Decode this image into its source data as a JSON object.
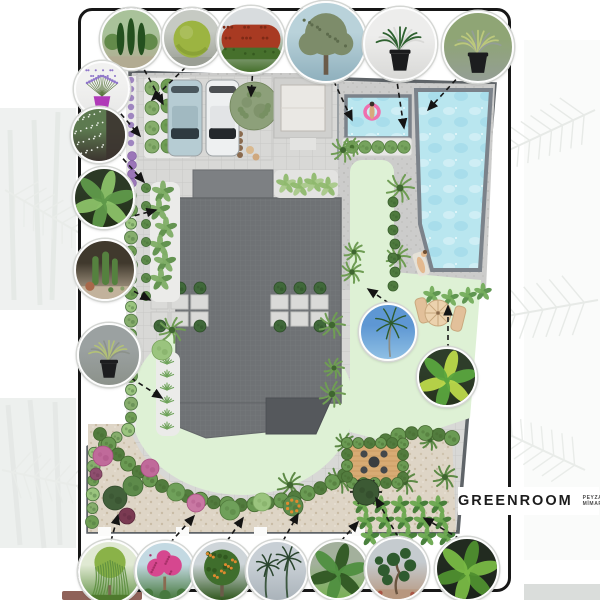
{
  "poster": {
    "kind": "residential-landscape-plan"
  },
  "logo": {
    "brand": "GREENROOM",
    "tagline_line1": "PEYZAJ",
    "tagline_line2": "MİMARLIK"
  },
  "site": {
    "colors": {
      "paving": "#d8d8d6",
      "tile_line": "#c8c8c6",
      "deck": "#cccccb",
      "gravel": "#ded5c6",
      "lawn": "#def1d5",
      "water": "#b9e6ef",
      "pool_edge": "#7b828a",
      "roof_dark": "#6f7275",
      "roof_mid": "#7d8083",
      "roof_low": "#55585c",
      "hedge": "#6a9a53",
      "hedge_dark": "#527c3e",
      "boundary": "#5f6468",
      "wood_deck": "#d8ab74",
      "umbrella": "#ecd2ae"
    },
    "figures": [
      "person-on-pink-float",
      "sunbathing-person"
    ]
  },
  "callouts": [
    {
      "name": "cypress-garden-photo",
      "glyph": "cypress",
      "x": 129,
      "y": 37,
      "r": 29,
      "sky": "#a9c29a",
      "mid": "#56813c",
      "base": "#b2ab92",
      "accent": "#24501f"
    },
    {
      "name": "boxwood-ball-photo",
      "glyph": "ball",
      "x": 190,
      "y": 36,
      "r": 28,
      "sky": "#c6cac3",
      "mid": "#9cb441",
      "base": "#9a9e94",
      "accent": "#778f2b"
    },
    {
      "name": "photinia-hedge-photo",
      "glyph": "hedge",
      "x": 249,
      "y": 38,
      "r": 32,
      "sky": "#d8dcde",
      "mid": "#a83a22",
      "base": "#46702c",
      "accent": "#7e2a16"
    },
    {
      "name": "olive-tree-photo",
      "glyph": "tree",
      "x": 324,
      "y": 40,
      "r": 39,
      "sky": "#b9d2da",
      "mid": "#7d8c6a",
      "base": "#8fb0bd",
      "accent": "#5d6b4c"
    },
    {
      "name": "sago-palm-pot-photo",
      "glyph": "potted",
      "x": 398,
      "y": 42,
      "r": 35,
      "sky": "#ededec",
      "mid": "#2f6230",
      "base": "#d9d9d7",
      "accent": "#1a1b1d"
    },
    {
      "name": "yucca-pot-photo",
      "glyph": "potted",
      "x": 476,
      "y": 45,
      "r": 34,
      "sky": "#8fa575",
      "mid": "#bcc87c",
      "base": "#949e95",
      "accent": "#1c1d1f"
    },
    {
      "name": "lavender-pot-photo",
      "glyph": "flowerpot",
      "x": 100,
      "y": 87,
      "r": 26,
      "sky": "#f1f1f0",
      "mid": "#8f76c9",
      "base": "#e8e8e7",
      "accent": "#b03ab8"
    },
    {
      "name": "jasmine-wall-photo",
      "glyph": "speckle-wall",
      "x": 97,
      "y": 133,
      "r": 26,
      "sky": "#5d7a50",
      "mid": "#eff3ec",
      "base": "#3c3430",
      "accent": "#50694a"
    },
    {
      "name": "tropical-banana-photo",
      "glyph": "banana",
      "x": 102,
      "y": 196,
      "r": 29,
      "sky": "#2c3a26",
      "mid": "#5f994a",
      "base": "#233018",
      "accent": "#8bc168"
    },
    {
      "name": "cactus-garden-photo",
      "glyph": "cactus",
      "x": 103,
      "y": 268,
      "r": 29,
      "sky": "#40392d",
      "mid": "#55813f",
      "base": "#c2b29c",
      "accent": "#a8684a"
    },
    {
      "name": "yucca-pot-2-photo",
      "glyph": "potted",
      "x": 107,
      "y": 353,
      "r": 30,
      "sky": "#9ba1a1",
      "mid": "#b3c177",
      "base": "#8c928b",
      "accent": "#1c1d1f"
    },
    {
      "name": "coconut-palm-photo",
      "glyph": "palm",
      "x": 386,
      "y": 330,
      "r": 27,
      "sky": "#5e97d3",
      "mid": "#2e5b2b",
      "base": "#8fc0e4",
      "accent": "#8d8d84"
    },
    {
      "name": "banana-plant-photo",
      "glyph": "banana",
      "x": 445,
      "y": 375,
      "r": 28,
      "sky": "#2e3d2a",
      "mid": "#5aa53e",
      "base": "#26331d",
      "accent": "#bcd84a"
    },
    {
      "name": "weeping-willow-photo",
      "glyph": "willow",
      "x": 108,
      "y": 570,
      "r": 30,
      "sky": "#e0e9d3",
      "mid": "#8ab248",
      "base": "#5c8e3f",
      "accent": "#4f7a2e"
    },
    {
      "name": "crape-myrtle-photo",
      "glyph": "flower-tree",
      "x": 163,
      "y": 569,
      "r": 28,
      "sky": "#c3d9e2",
      "mid": "#d6478f",
      "base": "#47793f",
      "accent": "#a83068"
    },
    {
      "name": "orange-tree-photo",
      "glyph": "fruit-tree",
      "x": 220,
      "y": 569,
      "r": 29,
      "sky": "#ced5d9",
      "mid": "#3f6e2c",
      "base": "#31581f",
      "accent": "#e08a2f"
    },
    {
      "name": "palms-sky-photo",
      "glyph": "palm",
      "x": 275,
      "y": 569,
      "r": 29,
      "sky": "#c8cfd5",
      "mid": "#2a452e",
      "base": "#aab3ba",
      "accent": "#3c5740"
    },
    {
      "name": "banana-grove-photo",
      "glyph": "banana",
      "x": 336,
      "y": 568,
      "r": 28,
      "sky": "#a3b09c",
      "mid": "#4f8f3f",
      "base": "#79b055",
      "accent": "#2f5722"
    },
    {
      "name": "niwaki-pine-photo",
      "glyph": "cloud-tree",
      "x": 395,
      "y": 567,
      "r": 30,
      "sky": "#c5cbcf",
      "mid": "#2f5b2f",
      "base": "#b7977e",
      "accent": "#6b5540"
    },
    {
      "name": "banana-dark-photo",
      "glyph": "banana",
      "x": 465,
      "y": 567,
      "r": 30,
      "sky": "#222b20",
      "mid": "#79b944",
      "base": "#1a221a",
      "accent": "#4f8f2f"
    }
  ],
  "connectors": [
    [
      140,
      62,
      163,
      104
    ],
    [
      192,
      61,
      152,
      100
    ],
    [
      253,
      67,
      251,
      96
    ],
    [
      330,
      73,
      352,
      120
    ],
    [
      396,
      75,
      404,
      128
    ],
    [
      462,
      73,
      428,
      110
    ],
    [
      115,
      107,
      140,
      136
    ],
    [
      117,
      152,
      144,
      182
    ],
    [
      126,
      218,
      156,
      210
    ],
    [
      126,
      287,
      150,
      300
    ],
    [
      131,
      378,
      162,
      398
    ],
    [
      396,
      308,
      368,
      289
    ],
    [
      448,
      349,
      448,
      306
    ],
    [
      111,
      541,
      118,
      515
    ],
    [
      170,
      543,
      194,
      516
    ],
    [
      227,
      541,
      243,
      518
    ],
    [
      283,
      541,
      298,
      514
    ],
    [
      341,
      541,
      358,
      522
    ],
    [
      398,
      537,
      376,
      498
    ],
    [
      460,
      539,
      424,
      518
    ]
  ]
}
